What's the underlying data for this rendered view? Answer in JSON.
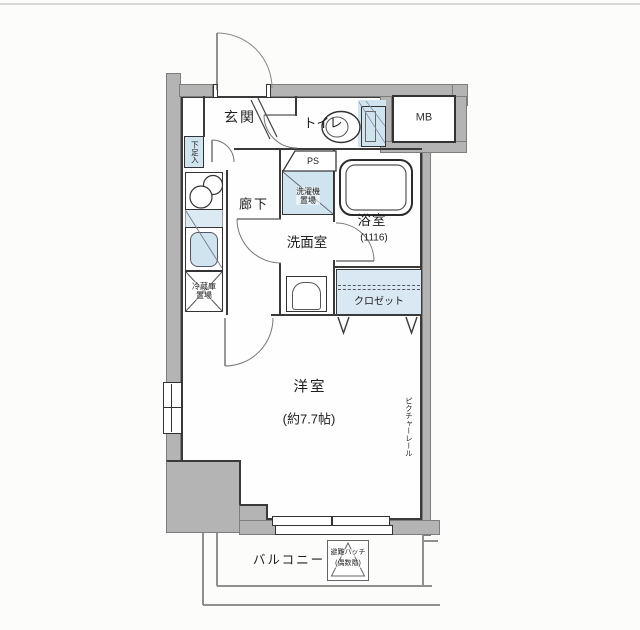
{
  "page": {
    "background": "#fcfcfa",
    "divider_color": "#d8d8d6"
  },
  "floorplan": {
    "wall_color": "#b4b4b4",
    "fixture_blue": "#cfe4ee",
    "closet_blue": "#d9e8f2",
    "line_color": "#3a3a3a",
    "rooms": {
      "genkan": "玄関",
      "toilet": "トイレ",
      "meter_box": "MB",
      "hallway": "廊下",
      "washroom": "洗面室",
      "bathroom": "浴室",
      "bathroom_module": "(1116)",
      "closet": "クロゼット",
      "western_room": "洋室",
      "western_room_size": "(約7.7帖)",
      "balcony": "バルコニー"
    },
    "fixtures": {
      "shoe_cabinet": "下足入",
      "pipe_space": "PS",
      "washer_line1": "洗濯機",
      "washer_line2": "置場",
      "fridge_line1": "冷蔵庫",
      "fridge_line2": "置場",
      "picture_rail": "ピクチャーレール",
      "escape_hatch_line1": "避難ハッチ",
      "escape_hatch_line2": "(偶数階)"
    }
  }
}
